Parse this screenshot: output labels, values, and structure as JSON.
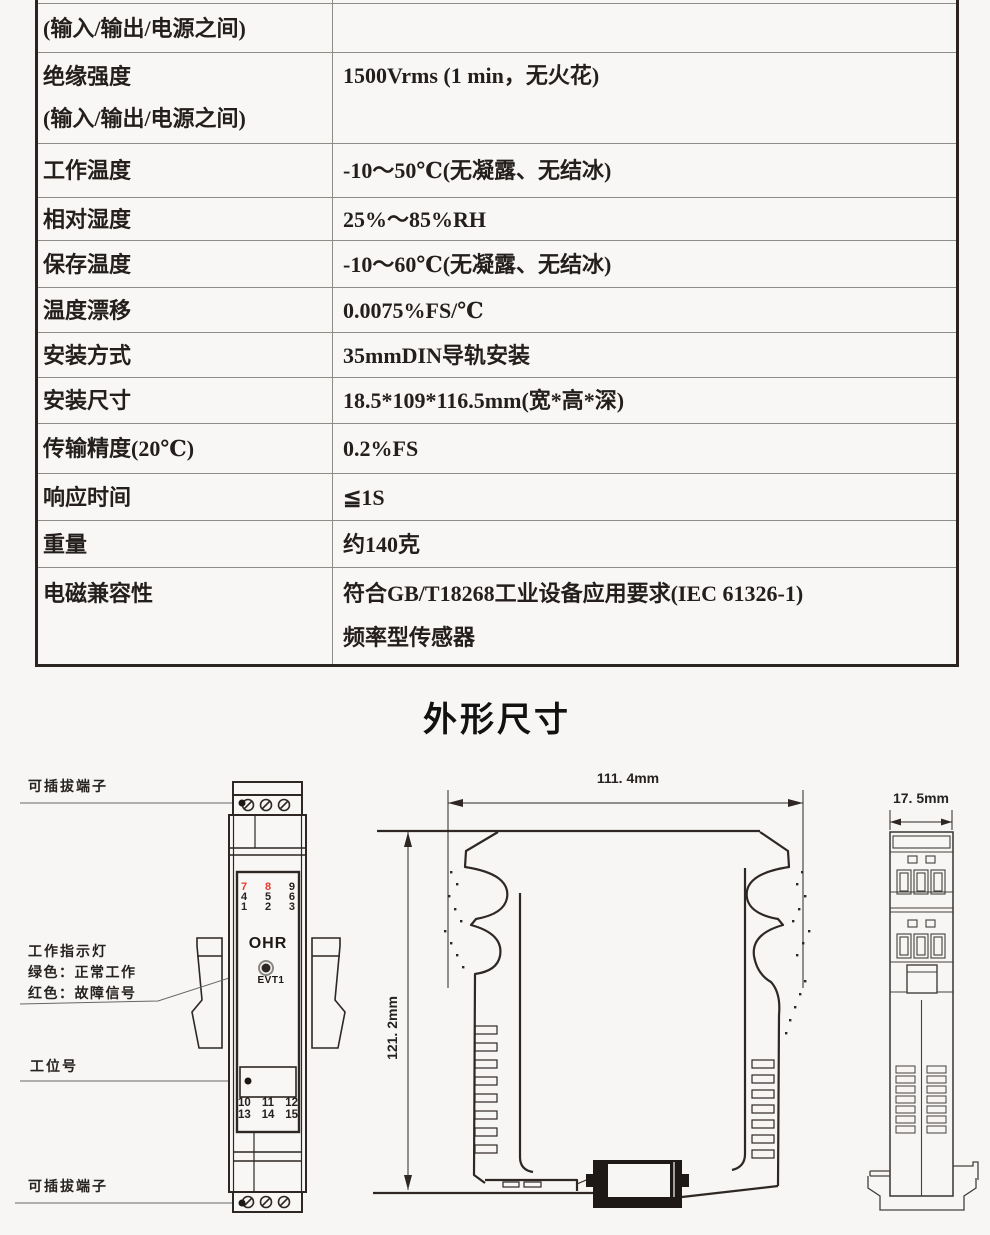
{
  "colors": {
    "red_terminal": "#e8392a",
    "line": "#2e2723",
    "table_border": "#2b2421"
  },
  "table": {
    "rows": [
      {
        "label": "(输入/输出/电源之间)",
        "value": ""
      },
      {
        "label": "绝缘强度\n(输入/输出/电源之间)",
        "value": "1500Vrms (1 min，无火花)"
      },
      {
        "label": "工作温度",
        "value": "-10～50℃(无凝露、无结冰)"
      },
      {
        "label": "相对湿度",
        "value": "25%～85%RH"
      },
      {
        "label": "保存温度",
        "value": "-10～60℃(无凝露、无结冰)"
      },
      {
        "label": "温度漂移",
        "value": "0.0075%FS/℃"
      },
      {
        "label": "安装方式",
        "value": "35mmDIN导轨安装"
      },
      {
        "label": "安装尺寸",
        "value": "18.5*109*116.5mm(宽*高*深)"
      },
      {
        "label": "传输精度(20℃)",
        "value": "0.2%FS"
      },
      {
        "label": "响应时间",
        "value": "≦1S"
      },
      {
        "label": "重量",
        "value": "约140克"
      },
      {
        "label": "电磁兼容性",
        "value": "符合GB/T18268工业设备应用要求(IEC 61326-1)\n频率型传感器"
      }
    ]
  },
  "section_title": "外形尺寸",
  "front_view": {
    "label_top_terminal": "可插拔端子",
    "label_indicator": "工作指示灯",
    "label_indicator_green": "绿色：正常工作",
    "label_indicator_red": "红色：故障信号",
    "label_tag_number": "工位号",
    "label_bottom_terminal": "可插拔端子",
    "brand": "OHR",
    "model": "EVT1",
    "terminals_top": [
      [
        "7",
        "8",
        "9"
      ],
      [
        "4",
        "5",
        "6"
      ],
      [
        "1",
        "2",
        "3"
      ]
    ],
    "terminals_bottom": [
      [
        "10",
        "11",
        "12"
      ],
      [
        "13",
        "14",
        "15"
      ]
    ]
  },
  "side_view": {
    "width_dim": "111. 4mm",
    "height_dim": "121. 2mm"
  },
  "top_view": {
    "width_dim": "17. 5mm"
  }
}
